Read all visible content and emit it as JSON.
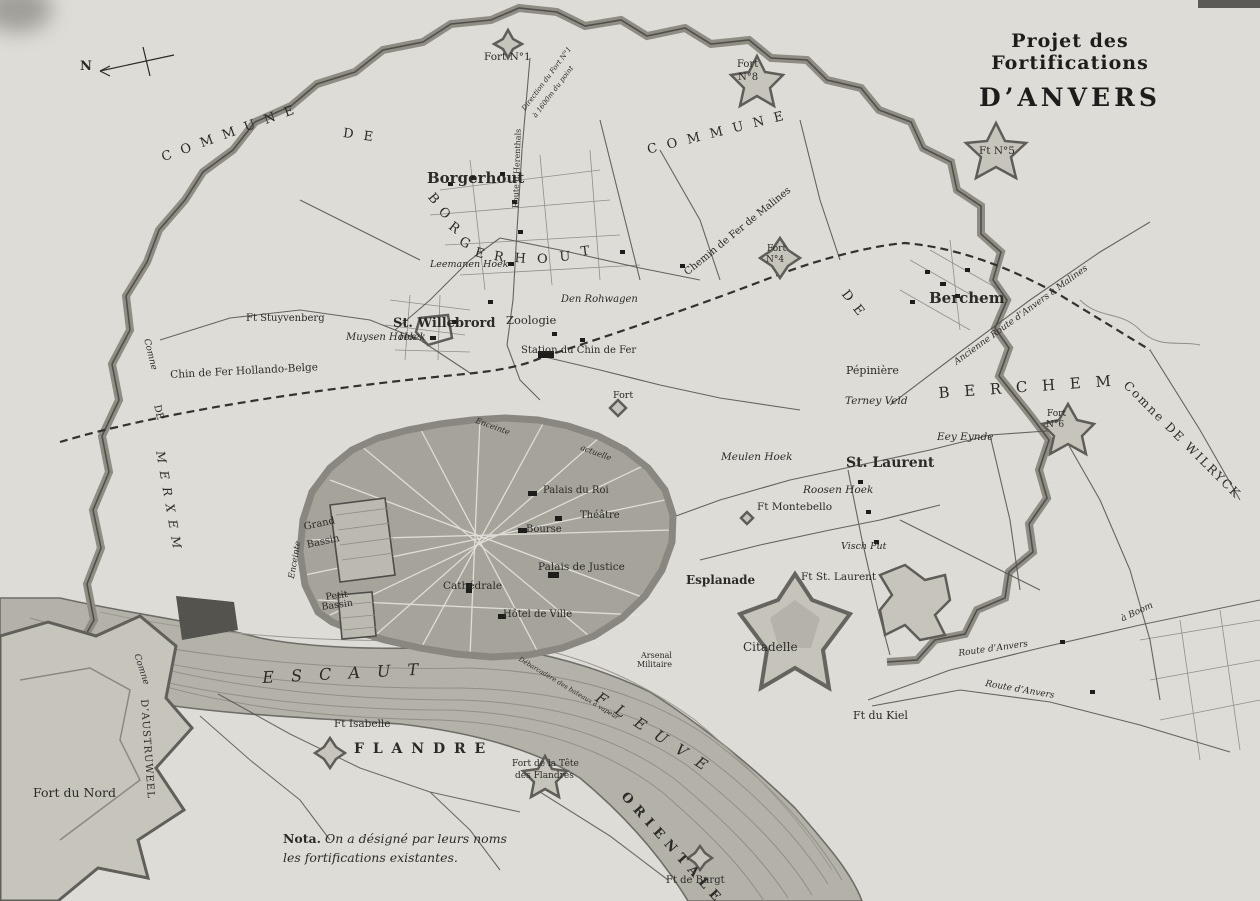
{
  "title": {
    "line1": "Projet des Fortifications",
    "line2": "D’ANVERS"
  },
  "note": {
    "lead": "Nota.",
    "line1": "On a désigné par leurs noms",
    "line2": "les fortifications existantes."
  },
  "colors": {
    "paper": "#dedcd6",
    "ink": "#2b2a27",
    "city_fill": "#a6a39a",
    "river_fill": "#b4b1a9",
    "fortification": "#8f8c83",
    "fort_fill": "#c7c4bc"
  },
  "compass": {
    "label": "N"
  },
  "labels": [
    {
      "name": "north-label",
      "t": "N",
      "x": 80,
      "y": 60,
      "s": 13,
      "b": 1
    },
    {
      "name": "commune-merxem-arc-1",
      "t": "C O M M U N E",
      "x": 160,
      "y": 152,
      "s": 13,
      "rot": -20,
      "sp": 3
    },
    {
      "name": "commune-merxem-arc-2",
      "t": "D E",
      "x": 344,
      "y": 127,
      "s": 13,
      "rot": 8,
      "sp": 3
    },
    {
      "name": "commune-borgerhout-arc",
      "t": "C O M M U N E",
      "x": 646,
      "y": 144,
      "s": 13,
      "rot": -14,
      "sp": 3
    },
    {
      "name": "commune-berchem-de",
      "t": "D E",
      "x": 849,
      "y": 288,
      "s": 13,
      "rot": 52,
      "sp": 2
    },
    {
      "name": "berchem-arc",
      "t": "B E R C H E M",
      "x": 938,
      "y": 386,
      "s": 15,
      "rot": -4,
      "sp": 5
    },
    {
      "name": "merxem-comne",
      "t": "Comne",
      "x": 150,
      "y": 338,
      "s": 9,
      "rot": 76,
      "i": 1
    },
    {
      "name": "merxem-de",
      "t": "DE",
      "x": 161,
      "y": 404,
      "s": 10,
      "rot": 78
    },
    {
      "name": "merxem-arc",
      "t": "M E R X E M",
      "x": 166,
      "y": 450,
      "s": 12,
      "rot": 80,
      "i": 1,
      "sp": 2
    },
    {
      "name": "austruweel-comne",
      "t": "Comne",
      "x": 140,
      "y": 653,
      "s": 9,
      "rot": 72,
      "i": 1
    },
    {
      "name": "austruweel",
      "t": "D’AUSTRUWEEL",
      "x": 148,
      "y": 699,
      "s": 10,
      "rot": 86,
      "sp": 1
    },
    {
      "name": "wilryck",
      "t": "Comne DE WILRYCK",
      "x": 1130,
      "y": 379,
      "s": 12,
      "rot": 45,
      "sp": 2
    },
    {
      "name": "borgerhout-arc-b",
      "t": "B",
      "x": 435,
      "y": 191,
      "s": 13,
      "rot": 50
    },
    {
      "name": "borgerhout-arc-o1",
      "t": "O",
      "x": 445,
      "y": 205,
      "s": 13,
      "rot": 45
    },
    {
      "name": "borgerhout-arc-r1",
      "t": "R",
      "x": 454,
      "y": 220,
      "s": 13,
      "rot": 38
    },
    {
      "name": "borgerhout-arc-g",
      "t": "G",
      "x": 463,
      "y": 235,
      "s": 13,
      "rot": 28
    },
    {
      "name": "borgerhout-arc-e1",
      "t": "E",
      "x": 477,
      "y": 246,
      "s": 13,
      "rot": 18
    },
    {
      "name": "borgerhout-arc-r2",
      "t": "R",
      "x": 495,
      "y": 250,
      "s": 13,
      "rot": 10
    },
    {
      "name": "borgerhout-arc-h",
      "t": "H",
      "x": 515,
      "y": 252,
      "s": 13,
      "rot": 4
    },
    {
      "name": "borgerhout-arc-o2",
      "t": "O",
      "x": 537,
      "y": 253,
      "s": 13,
      "rot": 0
    },
    {
      "name": "borgerhout-arc-u",
      "t": "U",
      "x": 559,
      "y": 251,
      "s": 13,
      "rot": -4
    },
    {
      "name": "borgerhout-arc-t",
      "t": "T",
      "x": 580,
      "y": 246,
      "s": 13,
      "rot": -8
    },
    {
      "name": "borgerhout-town",
      "t": "Borgerhout",
      "x": 427,
      "y": 171,
      "s": 15,
      "b": 1
    },
    {
      "name": "berchem-town",
      "t": "Berchem",
      "x": 929,
      "y": 291,
      "s": 15,
      "b": 1
    },
    {
      "name": "st-willebrord",
      "t": "St. Willebrord",
      "x": 393,
      "y": 317,
      "s": 13,
      "b": 1
    },
    {
      "name": "st-willebrord-hoek",
      "t": "Hoek",
      "x": 399,
      "y": 333,
      "s": 10,
      "i": 1
    },
    {
      "name": "st-laurent-town",
      "t": "St. Laurent",
      "x": 846,
      "y": 456,
      "s": 14,
      "b": 1
    },
    {
      "name": "muysen-hoek",
      "t": "Muysen Hoek",
      "x": 346,
      "y": 333,
      "s": 10,
      "i": 1
    },
    {
      "name": "leemanen-hoek",
      "t": "Leemanen Hoek",
      "x": 430,
      "y": 260,
      "s": 9.5,
      "i": 1
    },
    {
      "name": "den-rohwagen",
      "t": "Den Rohwagen",
      "x": 561,
      "y": 295,
      "s": 10,
      "i": 1
    },
    {
      "name": "meulen-hoek",
      "t": "Meulen Hoek",
      "x": 721,
      "y": 452,
      "s": 10.5,
      "i": 1
    },
    {
      "name": "roosen-hoek",
      "t": "Roosen Hoek",
      "x": 803,
      "y": 485,
      "s": 10.5,
      "i": 1
    },
    {
      "name": "terney-veld",
      "t": "Terney Veld",
      "x": 845,
      "y": 396,
      "s": 10.5,
      "i": 1
    },
    {
      "name": "eey-eynde",
      "t": "Eey Eynde",
      "x": 937,
      "y": 432,
      "s": 10.5,
      "i": 1
    },
    {
      "name": "visch-put",
      "t": "Visch Put",
      "x": 841,
      "y": 542,
      "s": 9.5,
      "i": 1
    },
    {
      "name": "pepiniere",
      "t": "Pépinière",
      "x": 846,
      "y": 365,
      "s": 11
    },
    {
      "name": "zoologie",
      "t": "Zoologie",
      "x": 506,
      "y": 315,
      "s": 11.5
    },
    {
      "name": "station-chemin-de-fer",
      "t": "Station du Chin de Fer",
      "x": 521,
      "y": 346,
      "s": 10
    },
    {
      "name": "chemin-de-fer-de-malines",
      "t": "Chemin de Fer de Malines",
      "x": 683,
      "y": 270,
      "s": 10,
      "rot": -39
    },
    {
      "name": "chemin-hollando-belge",
      "t": "Chin de Fer Hollando-Belge",
      "x": 170,
      "y": 370,
      "s": 10.5,
      "rot": -3
    },
    {
      "name": "ancienne-route-malines",
      "t": "Ancienne Route d’Anvers à Malines",
      "x": 953,
      "y": 360,
      "s": 9,
      "rot": -36,
      "i": 1
    },
    {
      "name": "route-herenthals",
      "t": "Route d’Herenthals",
      "x": 512,
      "y": 208,
      "s": 8,
      "rot": -88
    },
    {
      "name": "direction-fort-line1",
      "t": "Direction du Fort N°1",
      "x": 521,
      "y": 108,
      "s": 7,
      "rot": -53,
      "i": 1
    },
    {
      "name": "direction-fort-line2",
      "t": "à 1600m du point",
      "x": 532,
      "y": 115,
      "s": 7,
      "rot": -53,
      "i": 1
    },
    {
      "name": "fort-no1",
      "t": "Fort N°1",
      "x": 484,
      "y": 52,
      "s": 10.5
    },
    {
      "name": "fort-no8-line1",
      "t": "Fort",
      "x": 737,
      "y": 60,
      "s": 10
    },
    {
      "name": "fort-no8-line2",
      "t": "N°8",
      "x": 738,
      "y": 73,
      "s": 10
    },
    {
      "name": "ft-no5",
      "t": "Ft N°5",
      "x": 979,
      "y": 146,
      "s": 10.5
    },
    {
      "name": "fort-no4-line1",
      "t": "Fort",
      "x": 767,
      "y": 245,
      "s": 9
    },
    {
      "name": "fort-no4-line2",
      "t": "N°4",
      "x": 766,
      "y": 256,
      "s": 9
    },
    {
      "name": "fort-no6-line1",
      "t": "Fort",
      "x": 1047,
      "y": 410,
      "s": 9
    },
    {
      "name": "fort-no6-line2",
      "t": "N°6",
      "x": 1046,
      "y": 421,
      "s": 9
    },
    {
      "name": "ft-stuyvenberg",
      "t": "Ft Stuyvenberg",
      "x": 246,
      "y": 314,
      "s": 10
    },
    {
      "name": "fort-label",
      "t": "Fort",
      "x": 613,
      "y": 391,
      "s": 9.5
    },
    {
      "name": "enceinte-actuelle-1",
      "t": "Enceinte",
      "x": 477,
      "y": 417,
      "s": 8,
      "rot": 20,
      "i": 1
    },
    {
      "name": "enceinte-actuelle-2",
      "t": "actuelle",
      "x": 582,
      "y": 444,
      "s": 8,
      "rot": 20,
      "i": 1
    },
    {
      "name": "enceinte-west",
      "t": "Enceinte",
      "x": 288,
      "y": 578,
      "s": 8.5,
      "rot": -80,
      "i": 1
    },
    {
      "name": "palais-du-roi",
      "t": "Palais du Roi",
      "x": 543,
      "y": 486,
      "s": 10
    },
    {
      "name": "theatre",
      "t": "Théâtre",
      "x": 580,
      "y": 511,
      "s": 10
    },
    {
      "name": "bourse",
      "t": "Bourse",
      "x": 526,
      "y": 525,
      "s": 10
    },
    {
      "name": "palais-de-justice",
      "t": "Palais de Justice",
      "x": 538,
      "y": 562,
      "s": 10.5
    },
    {
      "name": "cathedrale",
      "t": "Cathédrale",
      "x": 443,
      "y": 581,
      "s": 10.5
    },
    {
      "name": "hotel-de-ville",
      "t": "Hôtel de Ville",
      "x": 503,
      "y": 610,
      "s": 10
    },
    {
      "name": "grand-bassin-line1",
      "t": "Grand",
      "x": 303,
      "y": 523,
      "s": 10,
      "rot": -12
    },
    {
      "name": "grand-bassin-line2",
      "t": "Bassin",
      "x": 306,
      "y": 541,
      "s": 10,
      "rot": -12
    },
    {
      "name": "petit-bassin-line1",
      "t": "Petit",
      "x": 325,
      "y": 593,
      "s": 9.5,
      "rot": -8
    },
    {
      "name": "petit-bassin-line2",
      "t": "Bassin",
      "x": 321,
      "y": 603,
      "s": 9.5,
      "rot": -8
    },
    {
      "name": "esplanade",
      "t": "Esplanade",
      "x": 686,
      "y": 574,
      "s": 12,
      "b": 1
    },
    {
      "name": "citadelle",
      "t": "Citadelle",
      "x": 743,
      "y": 641,
      "s": 12
    },
    {
      "name": "arsenal-line1",
      "t": "Arsenal",
      "x": 641,
      "y": 652,
      "s": 8
    },
    {
      "name": "arsenal-line2",
      "t": "Militaire",
      "x": 637,
      "y": 661,
      "s": 8
    },
    {
      "name": "ft-st-laurent",
      "t": "Ft St. Laurent",
      "x": 801,
      "y": 572,
      "s": 10.5
    },
    {
      "name": "ft-montebello",
      "t": "Ft Montebello",
      "x": 757,
      "y": 502,
      "s": 10.5
    },
    {
      "name": "escaut",
      "t": "E S C A U T",
      "x": 262,
      "y": 670,
      "s": 16,
      "i": 1,
      "sp": 6,
      "rot": -3
    },
    {
      "name": "fleuve",
      "t": "F L E U V E",
      "x": 601,
      "y": 690,
      "s": 15,
      "i": 1,
      "sp": 4,
      "rot": 33
    },
    {
      "name": "flandre",
      "t": "F L A N D R E",
      "x": 354,
      "y": 742,
      "s": 14,
      "b": 1,
      "sp": 2
    },
    {
      "name": "orientale",
      "t": "O R I E N T A L E",
      "x": 628,
      "y": 790,
      "s": 13,
      "b": 1,
      "sp": 1,
      "rot": 48
    },
    {
      "name": "ft-isabelle",
      "t": "Ft Isabelle",
      "x": 334,
      "y": 719,
      "s": 10.5
    },
    {
      "name": "fort-tete-flandres-line1",
      "t": "Fort de la Tête",
      "x": 512,
      "y": 760,
      "s": 9
    },
    {
      "name": "fort-tete-flandres-line2",
      "t": "des Flandres",
      "x": 515,
      "y": 772,
      "s": 9
    },
    {
      "name": "ft-de-burgt",
      "t": "Ft de Burgt",
      "x": 666,
      "y": 876,
      "s": 10
    },
    {
      "name": "fort-du-nord",
      "t": "Fort du Nord",
      "x": 33,
      "y": 787,
      "s": 12.5
    },
    {
      "name": "ft-du-kiel",
      "t": "Ft du Kiel",
      "x": 853,
      "y": 710,
      "s": 11
    },
    {
      "name": "route-anvers-1",
      "t": "Route   d’Anvers",
      "x": 958,
      "y": 650,
      "s": 9,
      "i": 1,
      "rot": -8
    },
    {
      "name": "route-a-boom",
      "t": "à  Boom",
      "x": 1120,
      "y": 616,
      "s": 9,
      "i": 1,
      "rot": -25
    },
    {
      "name": "route-anvers-2",
      "t": "Route   d’Anvers",
      "x": 986,
      "y": 680,
      "s": 9,
      "i": 1,
      "rot": 10
    },
    {
      "name": "debarcadere",
      "t": "Débarcadère des bateaux à vapeur",
      "x": 521,
      "y": 656,
      "s": 6.5,
      "i": 1,
      "rot": 31
    }
  ]
}
